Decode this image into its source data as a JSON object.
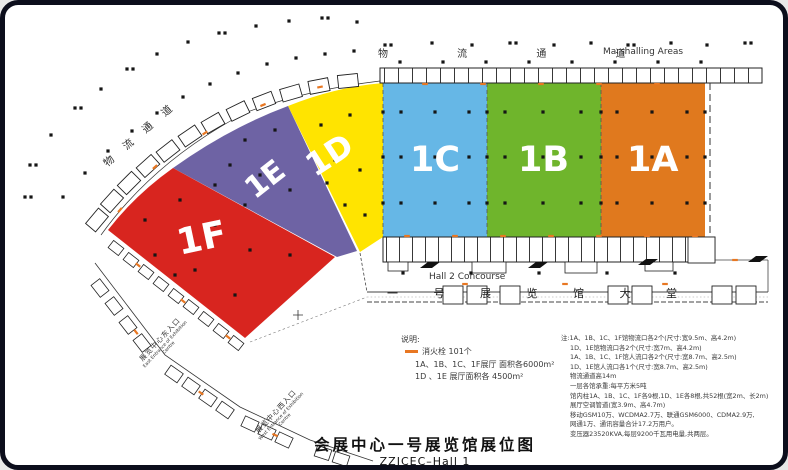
{
  "title": {
    "zh": "会展中心一号展览馆展位图",
    "en": "ZZICEC–Hall 1"
  },
  "map": {
    "corridor_top_zh": "物 流 通 道",
    "corridor_top_en": "Marshalling Areas",
    "corridor_left_zh": "物流通道",
    "hall2_concourse": "Hall 2 Concourse",
    "lobby": "一 号 展 览 馆 大 堂",
    "east_entrance_zh": "展览中心东入口",
    "east_entrance_en": "East Entrance of Exhibition Centre",
    "west_entrance_zh": "展览中心西入口",
    "west_entrance_en": "West Entrance of Exhibition Centre"
  },
  "halls": [
    {
      "id": "1A",
      "color": "#e0791e"
    },
    {
      "id": "1B",
      "color": "#6fb52c"
    },
    {
      "id": "1C",
      "color": "#66b7e6"
    },
    {
      "id": "1D",
      "color": "#ffe400"
    },
    {
      "id": "1E",
      "color": "#6e63a4"
    },
    {
      "id": "1F",
      "color": "#d8251f"
    }
  ],
  "legend": {
    "heading": "说明:",
    "hydrant_label": "消火栓 101个",
    "hydrant_color": "#e87722",
    "area_line1": "1A、1B、1C、1F展厅 面积各6000m²",
    "area_line2": "1D 、1E 展厅面积各 4500m²"
  },
  "notes": [
    "注:1A、1B、1C、1F馆物流口各2个(尺寸:宽9.5m、高4.2m)",
    "1D、1E馆物流口各2个(尺寸:宽7m、高4.2m)",
    "1A、1B、1C、1F馆人流口各2个(尺寸:宽8.7m、高2.5m)",
    "1D、1E馆人流口各1个(尺寸:宽8.7m、高2.5m)",
    "物流通道高14m",
    "一层各馆承重:每平方米5吨",
    "馆内柱1A、1B、1C、1F各9根,1D、1E各8根,共52根(宽2m、长2m)",
    "展厅空调管道(宽3.9m、高4.7m)",
    "移动GSM10万、WCDMA2.7万、联通GSM6000、CDMA2.9万,",
    "网通1万、通讯容量合计17.2万用户。",
    "变压器23520KVA,每层9200千瓦用电量,共两层。"
  ]
}
